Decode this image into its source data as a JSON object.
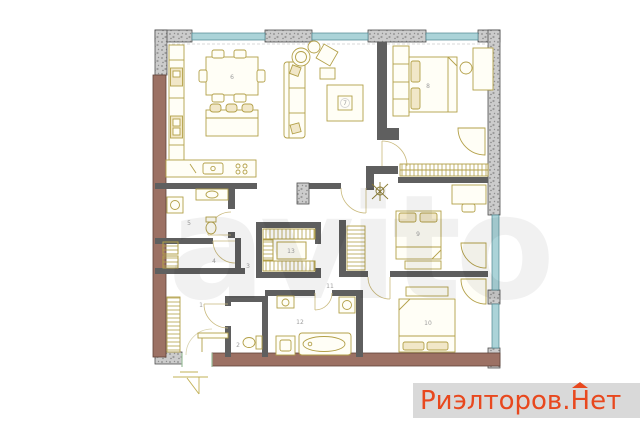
{
  "page": {
    "background": "#ffffff"
  },
  "watermark_center": {
    "text": "avito",
    "opacity": "0.05"
  },
  "brand": {
    "prefix": "Риэлторов.",
    "house_letter": "Н",
    "suffix": "ет",
    "color": "#e8481e",
    "background": "#d9d9d9"
  },
  "floorplan": {
    "colors": {
      "exterior_brick": "#9c7164",
      "exterior_concrete": "#cccccc",
      "window": "#abd3d8",
      "interior_wall": "#5f5f5f",
      "furniture": "#b3a049",
      "furniture_fill": "#fffef6",
      "label": "#9e9e9e",
      "door_arc": "#c9b97c",
      "entrance_frame": "#9bbf9b"
    },
    "rooms": [
      {
        "number": "1",
        "name": "hallway"
      },
      {
        "number": "2",
        "name": "wc"
      },
      {
        "number": "3",
        "name": "corridor"
      },
      {
        "number": "4",
        "name": "storage"
      },
      {
        "number": "5",
        "name": "laundry-room"
      },
      {
        "number": "6",
        "name": "kitchen-dining"
      },
      {
        "number": "7",
        "name": "living-room"
      },
      {
        "number": "8",
        "name": "bedroom-1"
      },
      {
        "number": "9",
        "name": "bedroom-2"
      },
      {
        "number": "10",
        "name": "bedroom-3"
      },
      {
        "number": "11",
        "name": "inner-hall"
      },
      {
        "number": "12",
        "name": "bathroom"
      },
      {
        "number": "13",
        "name": "walk-in-closet"
      }
    ]
  }
}
